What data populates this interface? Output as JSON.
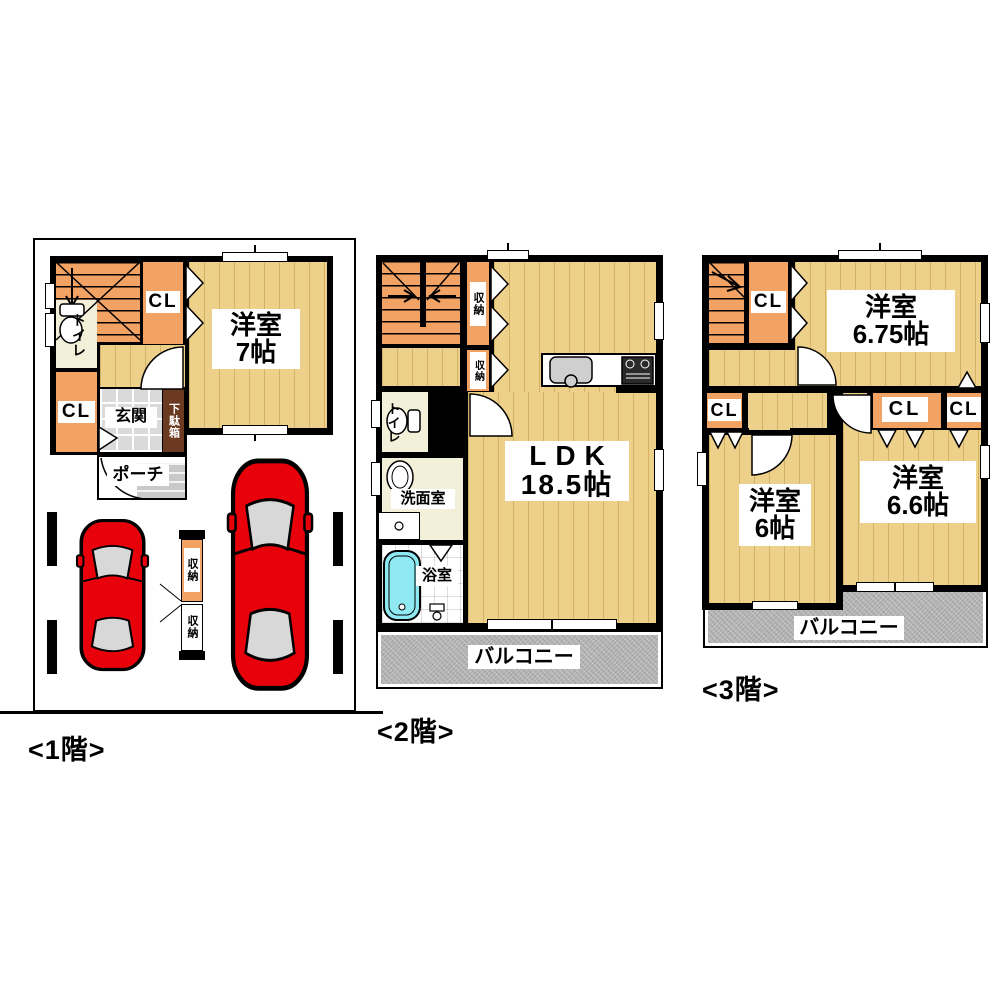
{
  "plan_title": "3-story house floor plan",
  "colors": {
    "wall": "#000000",
    "wood_floor": "#EDD08A",
    "accent_orange": "#F2A263",
    "cream": "#F3F0DA",
    "tile_gray": "#DADADA",
    "balcony_gray": "#B6B6B6",
    "shoe_cabinet_brown": "#6B3A20",
    "car_red": "#E8000A",
    "bathtub_blue": "#8FE9F2"
  },
  "floors": {
    "f1": {
      "caption": "<1階>",
      "labels": {
        "cl_top": "CL",
        "cl_bottom": "CL",
        "toilet": "トイレ",
        "entrance": "玄関",
        "shoe_cabinet": "下駄箱",
        "porch": "ポーチ",
        "room7_name": "洋室",
        "room7_size": "7帖",
        "storage_upper": "収納",
        "storage_lower": "収納"
      }
    },
    "f2": {
      "caption": "<2階>",
      "labels": {
        "storage_upper": "収納",
        "storage_lower": "収納",
        "toilet": "トイレ",
        "washroom": "洗面室",
        "bathroom": "浴室",
        "ldk_name": "LDK",
        "ldk_size": "18.5帖",
        "balcony": "バルコニー"
      }
    },
    "f3": {
      "caption": "<3階>",
      "labels": {
        "cl_stairs": "CL",
        "cl_west": "CL",
        "cl_mid": "CL",
        "cl_east": "CL",
        "room675_name": "洋室",
        "room675_size": "6.75帖",
        "room6_name": "洋室",
        "room6_size": "6帖",
        "room66_name": "洋室",
        "room66_size": "6.6帖",
        "balcony": "バルコニー"
      }
    }
  }
}
